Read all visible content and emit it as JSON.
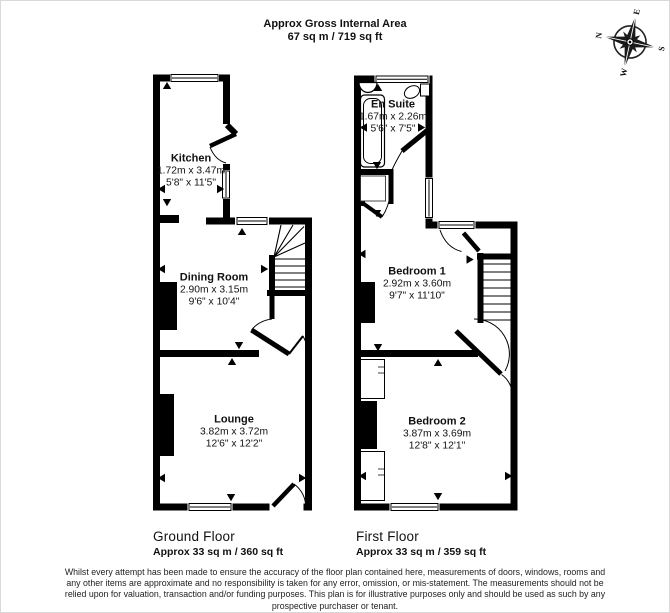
{
  "title": {
    "line1": "Approx Gross Internal Area",
    "line2": "67 sq m / 719 sq ft"
  },
  "compass": {
    "n": "N",
    "e": "E",
    "s": "S",
    "w": "W"
  },
  "floors": [
    {
      "label": "Ground Floor",
      "area": "Approx 33 sq m / 360 sq ft",
      "rooms": [
        {
          "name": "Kitchen",
          "metric": "1.72m x 3.47m",
          "imperial": "5'8\" x 11'5\""
        },
        {
          "name": "Dining Room",
          "metric": "2.90m x 3.15m",
          "imperial": "9'6\" x 10'4\""
        },
        {
          "name": "Lounge",
          "metric": "3.82m x 3.72m",
          "imperial": "12'6\" x 12'2\""
        }
      ]
    },
    {
      "label": "First Floor",
      "area": "Approx 33 sq m / 359 sq ft",
      "rooms": [
        {
          "name": "En Suite",
          "metric": "1.67m x 2.26m",
          "imperial": "5'6\" x 7'5\""
        },
        {
          "name": "Bedroom 1",
          "metric": "2.92m x 3.60m",
          "imperial": "9'7\" x 11'10\""
        },
        {
          "name": "Bedroom 2",
          "metric": "3.87m x 3.69m",
          "imperial": "12'8\" x 12'1\""
        }
      ]
    }
  ],
  "footer": {
    "lines": [
      "Whilst every attempt has been made to ensure the accuracy of the floor plan contained here, measurements of doors, windows, rooms and",
      "any other items are approximate and no responsibility is taken for any error, omission, or mis-statement. The measurements should not be",
      "relied upon for valuation, transaction and/or funding purposes. This plan is for illustrative purposes only and should be used as such by any",
      "prospective purchaser or tenant."
    ]
  }
}
